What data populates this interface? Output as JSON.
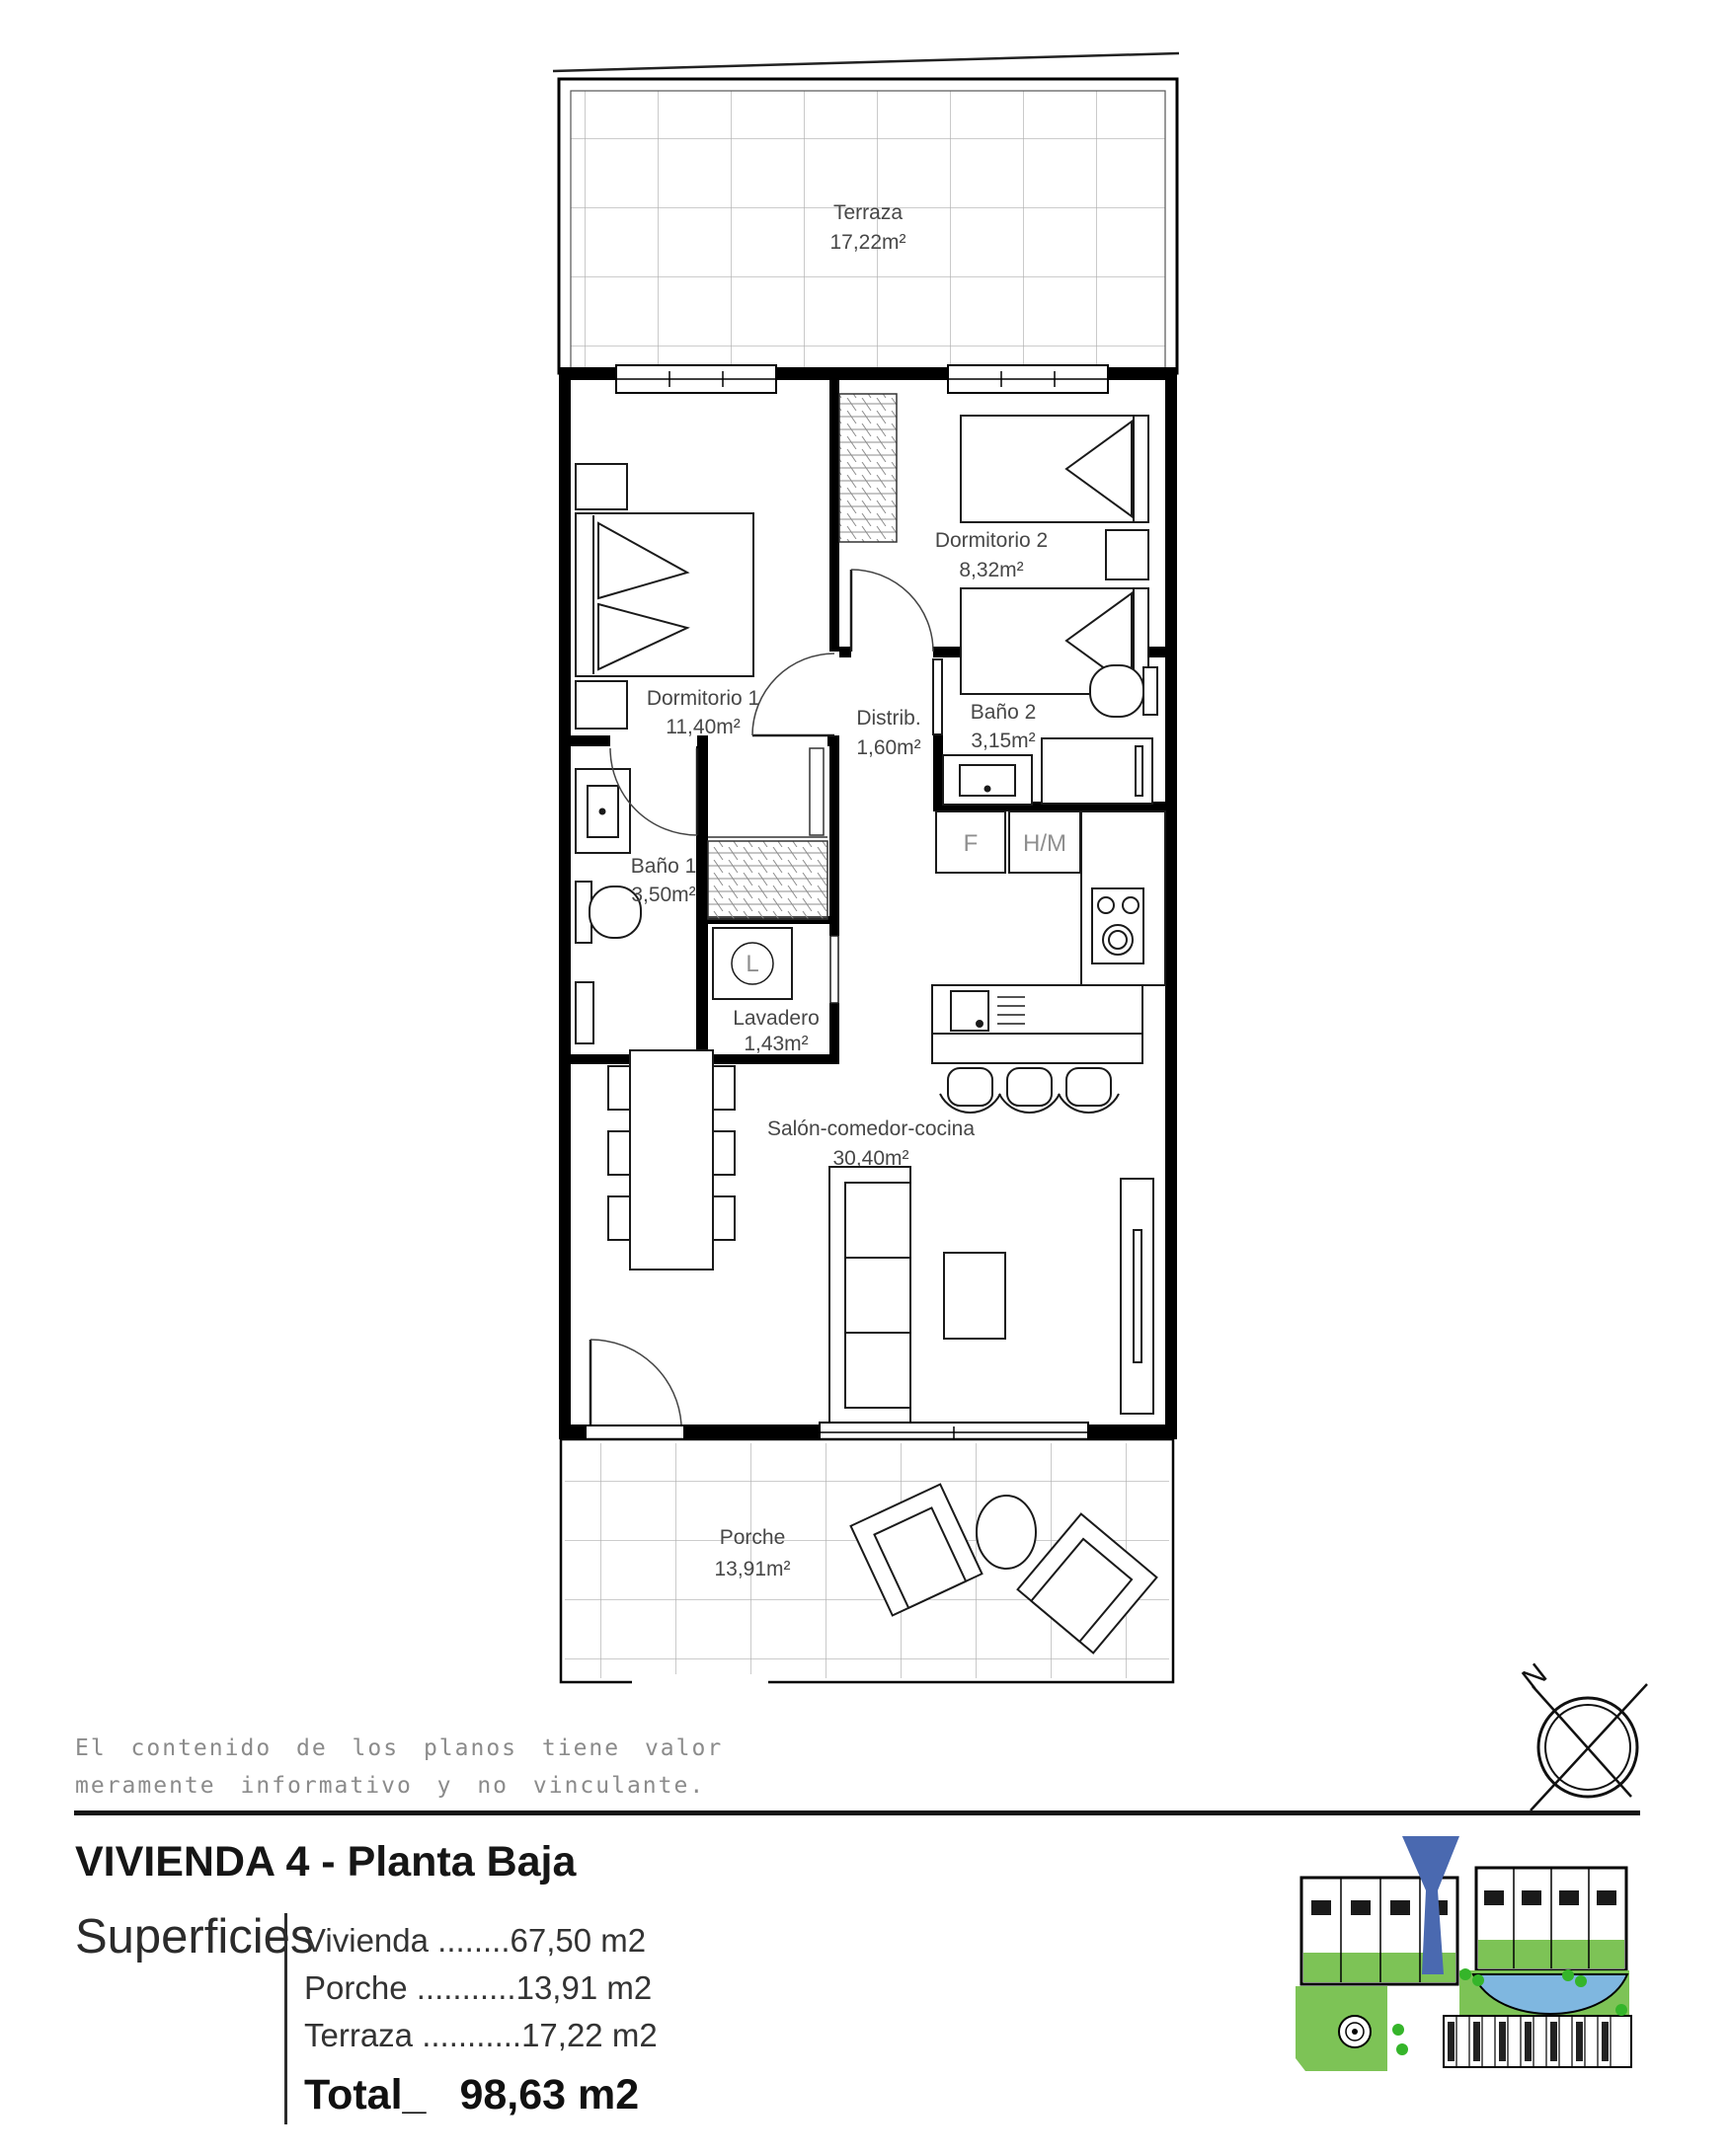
{
  "plan": {
    "rooms": [
      {
        "name": "Terraza",
        "area": "17,22m²"
      },
      {
        "name": "Dormitorio 1",
        "area": "11,40m²"
      },
      {
        "name": "Dormitorio 2",
        "area": "8,32m²"
      },
      {
        "name": "Distrib.",
        "area": "1,60m²"
      },
      {
        "name": "Baño 2",
        "area": "3,15m²"
      },
      {
        "name": "Baño 1",
        "area": "3,50m²"
      },
      {
        "name": "Lavadero",
        "area": "1,43m²"
      },
      {
        "name": "Salón-comedor-cocina",
        "area": "30,40m²"
      },
      {
        "name": "Porche",
        "area": "13,91m²"
      }
    ],
    "appliances": {
      "fridge": "F",
      "tall_unit": "H/M",
      "washer": "L"
    },
    "compass": {
      "north": "N"
    }
  },
  "disclaimer": {
    "line1": "El contenido de los planos tiene valor",
    "line2": "meramente informativo y no vinculante."
  },
  "title": "VIVIENDA 4 - Planta Baja",
  "surfaces": {
    "heading": "Superficies",
    "rows": [
      {
        "label": "Vivienda",
        "leader": " ........",
        "value": "67,50 m2"
      },
      {
        "label": "Porche",
        "leader": " ...........",
        "value": "13,91 m2"
      },
      {
        "label": "Terraza",
        "leader": " ...........",
        "value": "17,22 m2"
      }
    ],
    "total": {
      "label": "Total_",
      "value": "98,63 m2"
    }
  },
  "colors": {
    "wall": "#000000",
    "label_gray": "#474747",
    "muted_gray": "#8b8b8b",
    "accent_blue": "#4a69b0",
    "site_green": "#7dc356",
    "pool_blue": "#7fb7e0"
  }
}
